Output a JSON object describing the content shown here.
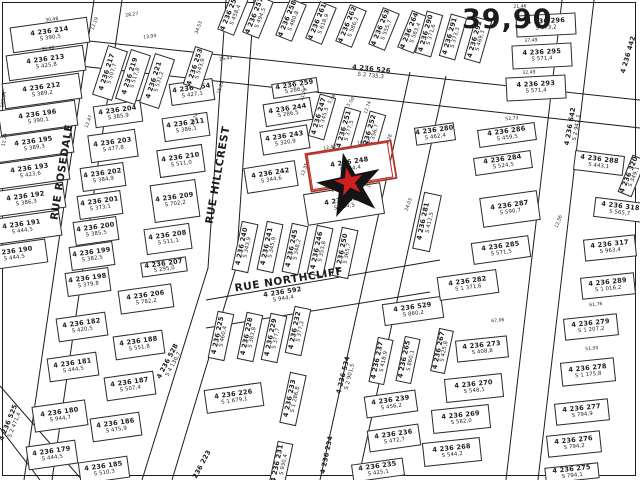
{
  "map": {
    "scale_label": "39,90",
    "background": "#ffffff",
    "line_color": "#1c1c1c",
    "highlight_color": "#b5312a",
    "star": {
      "outer_color": "#141414",
      "inner_color": "#cf2020",
      "x": 350,
      "y": 186,
      "rotation": -12
    }
  },
  "streets": [
    {
      "name": "RUE ROSEDALE",
      "x": 62,
      "y": 172,
      "r": -81
    },
    {
      "name": "RUE HILLCREST",
      "x": 218,
      "y": 175,
      "r": -80
    },
    {
      "name": "RUE NORTHCLIFF",
      "x": 289,
      "y": 280,
      "r": -9
    }
  ],
  "parcels": [
    {
      "n": "4 236 214",
      "s": "S 390,5",
      "x": 50,
      "y": 35,
      "w": 78,
      "h": 26,
      "r": -8
    },
    {
      "n": "4 236 213",
      "s": "S 425,8",
      "x": 46,
      "y": 63,
      "w": 78,
      "h": 26,
      "r": -8
    },
    {
      "n": "4 236 212",
      "s": "S 389,2",
      "x": 42,
      "y": 91,
      "w": 78,
      "h": 26,
      "r": -8
    },
    {
      "n": "4 236 196",
      "s": "S 390,1",
      "x": 38,
      "y": 118,
      "w": 78,
      "h": 26,
      "r": -8
    },
    {
      "n": "4 236 195",
      "s": "S 389,3",
      "x": 34,
      "y": 145,
      "w": 78,
      "h": 26,
      "r": -8
    },
    {
      "n": "4 236 193",
      "s": "S 423,6",
      "x": 30,
      "y": 172,
      "w": 78,
      "h": 26,
      "r": -8
    },
    {
      "n": "4 236 192",
      "s": "S 386,3",
      "x": 26,
      "y": 200,
      "w": 78,
      "h": 26,
      "r": -8
    },
    {
      "n": "4 236 191",
      "s": "S 444,5",
      "x": 22,
      "y": 228,
      "w": 78,
      "h": 26,
      "r": -8
    },
    {
      "n": "4 236 190",
      "s": "S 444,5",
      "x": 14,
      "y": 255,
      "w": 66,
      "h": 24,
      "r": -8
    },
    {
      "n": "4 236 204",
      "s": "S 385,9",
      "x": 118,
      "y": 114,
      "w": 48,
      "h": 22,
      "r": -8
    },
    {
      "n": "4 236 203",
      "s": "S 477,8",
      "x": 113,
      "y": 146,
      "w": 48,
      "h": 28,
      "r": -8
    },
    {
      "n": "4 236 202",
      "s": "S 384,9",
      "x": 103,
      "y": 177,
      "w": 44,
      "h": 24,
      "r": -8
    },
    {
      "n": "4 236 201",
      "s": "S 373,1",
      "x": 100,
      "y": 205,
      "w": 44,
      "h": 24,
      "r": -8
    },
    {
      "n": "4 236 200",
      "s": "S 385,5",
      "x": 96,
      "y": 231,
      "w": 44,
      "h": 24,
      "r": -8
    },
    {
      "n": "4 236 199",
      "s": "S 382,5",
      "x": 92,
      "y": 256,
      "w": 44,
      "h": 24,
      "r": -8
    },
    {
      "n": "4 236 198",
      "s": "S 379,8",
      "x": 88,
      "y": 282,
      "w": 44,
      "h": 24,
      "r": -8
    },
    {
      "n": "4 236 206",
      "s": "S 782,2",
      "x": 146,
      "y": 299,
      "w": 54,
      "h": 24,
      "r": -8
    },
    {
      "n": "4 236 207",
      "s": "S 295,0",
      "x": 164,
      "y": 267,
      "w": 46,
      "h": 15,
      "r": -8
    },
    {
      "n": "4 236 208",
      "s": "S 511,1",
      "x": 168,
      "y": 239,
      "w": 46,
      "h": 26,
      "r": -8
    },
    {
      "n": "4 236 209",
      "s": "S 702,2",
      "x": 175,
      "y": 201,
      "w": 46,
      "h": 38,
      "r": -8
    },
    {
      "n": "4 236 210",
      "s": "S 511,0",
      "x": 181,
      "y": 161,
      "w": 46,
      "h": 28,
      "r": -8
    },
    {
      "n": "4 236 211",
      "s": "S 386,1",
      "x": 186,
      "y": 127,
      "w": 46,
      "h": 24,
      "r": -8
    },
    {
      "n": "4 236 254",
      "s": "S 427,1",
      "x": 192,
      "y": 92,
      "w": 44,
      "h": 22,
      "r": -8
    },
    {
      "n": "4 236 253",
      "s": "S 543,9",
      "x": 198,
      "y": 68,
      "w": 40,
      "h": 19,
      "r": -72
    },
    {
      "n": "4 236 217",
      "s": "S 507,7",
      "x": 110,
      "y": 73,
      "w": 52,
      "h": 21,
      "r": -72
    },
    {
      "n": "4 236 219",
      "s": "S 517,8",
      "x": 133,
      "y": 77,
      "w": 52,
      "h": 21,
      "r": -72
    },
    {
      "n": "4 236 221",
      "s": "S 531,2",
      "x": 157,
      "y": 81,
      "w": 52,
      "h": 21,
      "r": -72
    },
    {
      "n": "4 236 256",
      "s": "S 458,4",
      "x": 233,
      "y": 14,
      "w": 40,
      "h": 18,
      "r": -68
    },
    {
      "n": "4 236 257",
      "s": "S 494,5",
      "x": 258,
      "y": 17,
      "w": 40,
      "h": 18,
      "r": -68
    },
    {
      "n": "4 236 258",
      "s": "S 480,8",
      "x": 291,
      "y": 20,
      "w": 40,
      "h": 18,
      "r": -68
    },
    {
      "n": "4 236 261",
      "s": "S 618,9",
      "x": 321,
      "y": 23,
      "w": 40,
      "h": 18,
      "r": -68
    },
    {
      "n": "4 236 262",
      "s": "S 586,2",
      "x": 351,
      "y": 26,
      "w": 40,
      "h": 18,
      "r": -68
    },
    {
      "n": "4 236 263",
      "s": "S 555,7",
      "x": 384,
      "y": 29,
      "w": 40,
      "h": 18,
      "r": -68
    },
    {
      "n": "4 236 264",
      "s": "S 563,4",
      "x": 413,
      "y": 32,
      "w": 40,
      "h": 18,
      "r": -68
    },
    {
      "n": "4 236 259",
      "s": "S 286,1",
      "x": 295,
      "y": 88,
      "w": 46,
      "h": 15,
      "r": -9
    },
    {
      "n": "4 236 244",
      "s": "S 286,5",
      "x": 288,
      "y": 112,
      "w": 48,
      "h": 23,
      "r": -9
    },
    {
      "n": "4 236 243",
      "s": "S 320,9",
      "x": 285,
      "y": 140,
      "w": 48,
      "h": 24,
      "r": -9
    },
    {
      "n": "4 236 242",
      "s": "S 344,6",
      "x": 271,
      "y": 177,
      "w": 52,
      "h": 26,
      "r": -9
    },
    {
      "n": "4 236 248",
      "s": "S 464,4",
      "x": 350,
      "y": 166,
      "w": 82,
      "h": 36,
      "r": -9,
      "hl": true
    },
    {
      "n": "4 236 651",
      "s": "S 464,5",
      "x": 344,
      "y": 204,
      "w": 78,
      "h": 32,
      "r": -9
    },
    {
      "n": "4 236 247",
      "s": "S 345,5",
      "x": 322,
      "y": 117,
      "w": 44,
      "h": 17,
      "r": -74
    },
    {
      "n": "4 236 251",
      "s": "S 377,5",
      "x": 347,
      "y": 130,
      "w": 44,
      "h": 17,
      "r": -74
    },
    {
      "n": "4 236 252",
      "s": "S 356,7",
      "x": 372,
      "y": 134,
      "w": 44,
      "h": 17,
      "r": -74
    },
    {
      "n": "4 236 240",
      "s": "S 343,9",
      "x": 245,
      "y": 247,
      "w": 50,
      "h": 17,
      "r": -78
    },
    {
      "n": "4 236 241",
      "s": "S 345,9",
      "x": 270,
      "y": 247,
      "w": 50,
      "h": 17,
      "r": -78
    },
    {
      "n": "4 236 245",
      "s": "S 348,2",
      "x": 295,
      "y": 249,
      "w": 50,
      "h": 17,
      "r": -78
    },
    {
      "n": "4 236 246",
      "s": "S 353,8",
      "x": 320,
      "y": 251,
      "w": 50,
      "h": 17,
      "r": -78
    },
    {
      "n": "4 236 250",
      "s": "S 365,7",
      "x": 345,
      "y": 253,
      "w": 50,
      "h": 17,
      "r": -78
    },
    {
      "n": "4 236 281",
      "s": "S 412,5",
      "x": 427,
      "y": 222,
      "w": 58,
      "h": 18,
      "r": -78
    },
    {
      "n": "4 236 225",
      "s": "S 460,4",
      "x": 221,
      "y": 336,
      "w": 48,
      "h": 17,
      "r": -78
    },
    {
      "n": "4 236 228",
      "s": "S 383,8",
      "x": 250,
      "y": 337,
      "w": 48,
      "h": 17,
      "r": -78
    },
    {
      "n": "4 236 229",
      "s": "S 377,7",
      "x": 274,
      "y": 338,
      "w": 48,
      "h": 17,
      "r": -78
    },
    {
      "n": "4 236 232",
      "s": "S 377,3",
      "x": 298,
      "y": 331,
      "w": 48,
      "h": 17,
      "r": -78
    },
    {
      "n": "4 236 226",
      "s": "S 1 679,1",
      "x": 234,
      "y": 398,
      "w": 58,
      "h": 24,
      "r": -8
    },
    {
      "n": "4 236 233",
      "s": "S 1 286,8",
      "x": 293,
      "y": 399,
      "w": 52,
      "h": 17,
      "r": -78
    },
    {
      "n": "4 236 231",
      "s": "S 930,4",
      "x": 281,
      "y": 464,
      "w": 44,
      "h": 16,
      "r": -78
    },
    {
      "n": "4 236 234",
      "s": "",
      "x": 327,
      "y": 455,
      "w": 40,
      "h": 13,
      "r": -78,
      "box": false
    },
    {
      "n": "4 236 223",
      "s": "",
      "x": 201,
      "y": 468,
      "w": 34,
      "h": 12,
      "r": -62,
      "box": false
    },
    {
      "n": "4 236 182",
      "s": "S 420,5",
      "x": 82,
      "y": 327,
      "w": 50,
      "h": 24,
      "r": -8
    },
    {
      "n": "4 236 181",
      "s": "S 444,5",
      "x": 73,
      "y": 367,
      "w": 50,
      "h": 24,
      "r": -8
    },
    {
      "n": "4 236 180",
      "s": "S 944,7",
      "x": 60,
      "y": 416,
      "w": 54,
      "h": 26,
      "r": -8
    },
    {
      "n": "4 236 179",
      "s": "S 444,5",
      "x": 52,
      "y": 455,
      "w": 50,
      "h": 24,
      "r": -8
    },
    {
      "n": "4 236 188",
      "s": "S 551,8",
      "x": 139,
      "y": 345,
      "w": 50,
      "h": 24,
      "r": -8
    },
    {
      "n": "4 236 187",
      "s": "S 507,4",
      "x": 130,
      "y": 386,
      "w": 50,
      "h": 24,
      "r": -8
    },
    {
      "n": "4 236 186",
      "s": "S 475,9",
      "x": 116,
      "y": 427,
      "w": 50,
      "h": 24,
      "r": -8
    },
    {
      "n": "4 236 185",
      "s": "S 510,3",
      "x": 104,
      "y": 470,
      "w": 50,
      "h": 22,
      "r": -8
    },
    {
      "n": "4 236 529",
      "s": "S 860,2",
      "x": 413,
      "y": 311,
      "w": 60,
      "h": 22,
      "r": -8
    },
    {
      "n": "4 236 237",
      "s": "S 418,9",
      "x": 381,
      "y": 361,
      "w": 46,
      "h": 16,
      "r": -78
    },
    {
      "n": "4 236 265",
      "s": "S 860,1",
      "x": 408,
      "y": 360,
      "w": 46,
      "h": 16,
      "r": -78
    },
    {
      "n": "4 236 239",
      "s": "S 456,2",
      "x": 391,
      "y": 404,
      "w": 52,
      "h": 22,
      "r": -8
    },
    {
      "n": "4 236 236",
      "s": "S 472,7",
      "x": 394,
      "y": 438,
      "w": 52,
      "h": 22,
      "r": -8
    },
    {
      "n": "4 236 235",
      "s": "S 425,1",
      "x": 378,
      "y": 470,
      "w": 52,
      "h": 18,
      "r": -8
    },
    {
      "n": "4 236 267",
      "s": "S 425,8",
      "x": 442,
      "y": 351,
      "w": 44,
      "h": 15,
      "r": -78
    },
    {
      "n": "4 236 273",
      "s": "S 408,8",
      "x": 482,
      "y": 349,
      "w": 52,
      "h": 22,
      "r": -6
    },
    {
      "n": "4 236 270",
      "s": "S 548,1",
      "x": 474,
      "y": 388,
      "w": 58,
      "h": 24,
      "r": -6
    },
    {
      "n": "4 236 269",
      "s": "S 582,0",
      "x": 461,
      "y": 419,
      "w": 58,
      "h": 24,
      "r": -6
    },
    {
      "n": "4 236 268",
      "s": "S 544,2",
      "x": 452,
      "y": 452,
      "w": 58,
      "h": 24,
      "r": -6
    },
    {
      "n": "4 236 282",
      "s": "S 1 371,6",
      "x": 468,
      "y": 285,
      "w": 60,
      "h": 24,
      "r": -8
    },
    {
      "n": "4 236 285",
      "s": "S 571,5",
      "x": 501,
      "y": 250,
      "w": 58,
      "h": 22,
      "r": -8
    },
    {
      "n": "4 236 287",
      "s": "S 590,7",
      "x": 510,
      "y": 209,
      "w": 58,
      "h": 30,
      "r": -8
    },
    {
      "n": "4 236 284",
      "s": "S 524,5",
      "x": 503,
      "y": 163,
      "w": 58,
      "h": 18,
      "r": -8
    },
    {
      "n": "4 236 286",
      "s": "S 459,5",
      "x": 507,
      "y": 135,
      "w": 58,
      "h": 18,
      "r": -8
    },
    {
      "n": "4 236 280",
      "s": "S 462,4",
      "x": 435,
      "y": 134,
      "w": 40,
      "h": 18,
      "r": -8
    },
    {
      "n": "4 236 293",
      "s": "S 571,4",
      "x": 536,
      "y": 88,
      "w": 60,
      "h": 24,
      "r": -3
    },
    {
      "n": "4 236 295",
      "s": "S 571,4",
      "x": 542,
      "y": 56,
      "w": 60,
      "h": 24,
      "r": -3
    },
    {
      "n": "4 236 296",
      "s": "S 573,2",
      "x": 546,
      "y": 25,
      "w": 60,
      "h": 22,
      "r": -3
    },
    {
      "n": "4 236 290",
      "s": "S 371,6",
      "x": 429,
      "y": 34,
      "w": 44,
      "h": 17,
      "r": -74
    },
    {
      "n": "4 236 291",
      "s": "S 373,3",
      "x": 453,
      "y": 37,
      "w": 44,
      "h": 17,
      "r": -74
    },
    {
      "n": "4 236 292",
      "s": "S 469,3",
      "x": 478,
      "y": 40,
      "w": 44,
      "h": 17,
      "r": -74
    },
    {
      "n": "4 236 288",
      "s": "S 443,1",
      "x": 599,
      "y": 163,
      "w": 50,
      "h": 20,
      "r": 7
    },
    {
      "n": "4 236 320",
      "s": "S 349,1",
      "x": 632,
      "y": 176,
      "w": 40,
      "h": 15,
      "r": -68
    },
    {
      "n": "4 236 318",
      "s": "S 565,7",
      "x": 620,
      "y": 210,
      "w": 52,
      "h": 20,
      "r": 7
    },
    {
      "n": "4 236 317",
      "s": "S 963,4",
      "x": 610,
      "y": 248,
      "w": 52,
      "h": 22,
      "r": -6
    },
    {
      "n": "4 236 289",
      "s": "S 1 016,2",
      "x": 608,
      "y": 286,
      "w": 54,
      "h": 22,
      "r": -6
    },
    {
      "n": "4 236 279",
      "s": "S 1 207,2",
      "x": 591,
      "y": 327,
      "w": 54,
      "h": 22,
      "r": -6
    },
    {
      "n": "4 236 278",
      "s": "S 1 175,8",
      "x": 588,
      "y": 372,
      "w": 54,
      "h": 24,
      "r": -6
    },
    {
      "n": "4 236 277",
      "s": "S 794,9",
      "x": 582,
      "y": 412,
      "w": 54,
      "h": 22,
      "r": -6
    },
    {
      "n": "4 236 276",
      "s": "S 794,2",
      "x": 574,
      "y": 444,
      "w": 54,
      "h": 22,
      "r": -6
    },
    {
      "n": "4 236 275",
      "s": "S 794,1",
      "x": 572,
      "y": 473,
      "w": 54,
      "h": 16,
      "r": -6
    },
    {
      "n": "4 236 442",
      "s": "",
      "x": 629,
      "y": 55,
      "w": 42,
      "h": 14,
      "r": -74,
      "box": false
    },
    {
      "n": "4 236 526",
      "s": "S 2 735,3",
      "x": 371,
      "y": 73,
      "w": 110,
      "h": 16,
      "r": 6,
      "box": false
    },
    {
      "n": "4 236 642",
      "s": "S 2 941,1",
      "x": 574,
      "y": 127,
      "w": 70,
      "h": 16,
      "r": -80,
      "box": false
    },
    {
      "n": "4 236 534",
      "s": "S 2 901,5",
      "x": 347,
      "y": 376,
      "w": 70,
      "h": 16,
      "r": -76,
      "box": false
    },
    {
      "n": "4 236 592",
      "s": "S 944,4",
      "x": 283,
      "y": 296,
      "w": 60,
      "h": 14,
      "r": -9,
      "box": false
    },
    {
      "n": "4 236 525",
      "s": "S 2 471,4",
      "x": 12,
      "y": 424,
      "w": 60,
      "h": 14,
      "r": -68,
      "box": false
    },
    {
      "n": "4 236 528",
      "s": "S 4 130,7",
      "x": 171,
      "y": 363,
      "w": 64,
      "h": 14,
      "r": -62,
      "box": false
    }
  ],
  "dimensions": [
    {
      "t": "28,27",
      "x": 132,
      "y": 16,
      "r": -8
    },
    {
      "t": "12,19",
      "x": 96,
      "y": 24,
      "r": -70
    },
    {
      "t": "13,94",
      "x": 150,
      "y": 38,
      "r": -8
    },
    {
      "t": "30,48",
      "x": 52,
      "y": 21,
      "r": -8
    },
    {
      "t": "36,40",
      "x": 48,
      "y": 50,
      "r": -8
    },
    {
      "t": "108,04",
      "x": 5,
      "y": 100,
      "r": -80
    },
    {
      "t": "12,24",
      "x": 6,
      "y": 140,
      "r": -80
    },
    {
      "t": "12,47",
      "x": 90,
      "y": 122,
      "r": -70
    },
    {
      "t": "34,53",
      "x": 200,
      "y": 28,
      "r": -70
    },
    {
      "t": "15,24",
      "x": 222,
      "y": 88,
      "r": -70
    },
    {
      "t": "29,24",
      "x": 196,
      "y": 120,
      "r": -70
    },
    {
      "t": "25,43",
      "x": 226,
      "y": 60,
      "r": -8
    },
    {
      "t": "11,79",
      "x": 305,
      "y": 95,
      "r": -70
    },
    {
      "t": "5,36",
      "x": 333,
      "y": 100,
      "r": -55
    },
    {
      "t": "5,50",
      "x": 352,
      "y": 103,
      "r": -55
    },
    {
      "t": "12,74",
      "x": 369,
      "y": 108,
      "r": -70
    },
    {
      "t": "12,42",
      "x": 330,
      "y": 149,
      "r": -9
    },
    {
      "t": "10,52",
      "x": 364,
      "y": 144,
      "r": -9
    },
    {
      "t": "32,42",
      "x": 352,
      "y": 158,
      "r": -9
    },
    {
      "t": "30,48",
      "x": 338,
      "y": 191,
      "r": -9
    },
    {
      "t": "12,35",
      "x": 306,
      "y": 170,
      "r": -70
    },
    {
      "t": "24,03",
      "x": 410,
      "y": 205,
      "r": -70
    },
    {
      "t": "21,46",
      "x": 520,
      "y": 8,
      "r": -3
    },
    {
      "t": "37,49",
      "x": 531,
      "y": 42,
      "r": -3
    },
    {
      "t": "32,49",
      "x": 529,
      "y": 74,
      "r": -3
    },
    {
      "t": "52,73",
      "x": 512,
      "y": 120,
      "r": -6
    },
    {
      "t": "67,06",
      "x": 498,
      "y": 322,
      "r": -6
    },
    {
      "t": "61,76",
      "x": 596,
      "y": 306,
      "r": -6
    },
    {
      "t": "51,50",
      "x": 592,
      "y": 350,
      "r": -6
    },
    {
      "t": "12,56",
      "x": 560,
      "y": 222,
      "r": -70
    },
    {
      "t": "13,28",
      "x": 390,
      "y": 141,
      "r": -70
    },
    {
      "t": "17,07",
      "x": 372,
      "y": 182,
      "r": -70
    }
  ]
}
